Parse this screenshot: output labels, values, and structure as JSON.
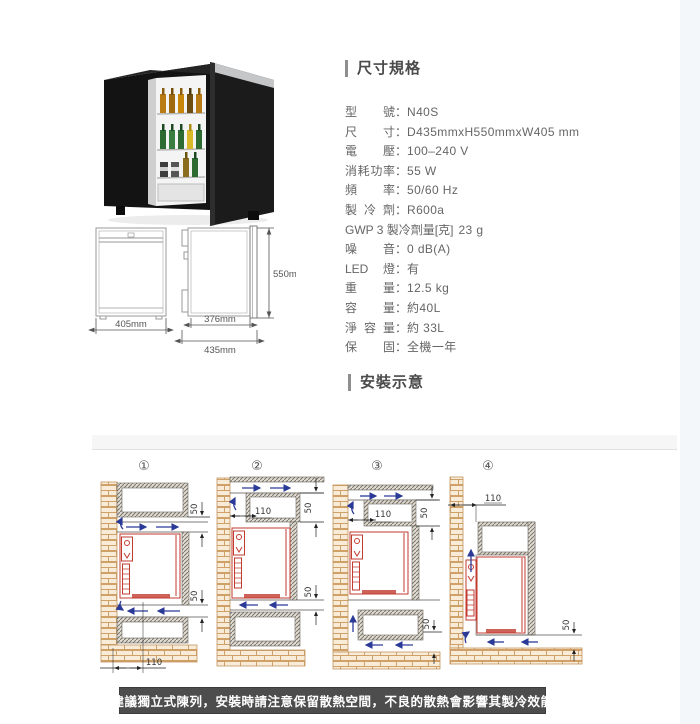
{
  "dimension_drawing": {
    "front_width": "405mm",
    "body_depth": "376mm",
    "total_depth": "435mm",
    "height": "550mm"
  },
  "specs": {
    "heading": "尺寸規格",
    "items": [
      {
        "label": "型號",
        "sep": "：",
        "value": "N40S"
      },
      {
        "label": "尺寸",
        "sep": "：",
        "value": "D435mmxH550mmxW405 mm"
      },
      {
        "label": "電壓",
        "sep": "：",
        "value": "100–240 V"
      },
      {
        "label": "消耗功率",
        "sep": "：",
        "value": "55 W"
      },
      {
        "label": "頻率",
        "sep": "：",
        "value": "50/60 Hz"
      },
      {
        "label": "製冷劑",
        "sep": "：",
        "value": "R600a"
      },
      {
        "label": "GWP 3 製冷劑量[克]",
        "sep": " ",
        "value": "23 g"
      },
      {
        "label": "噪音",
        "sep": "：",
        "value": "0 dB(A)"
      },
      {
        "label": "LED燈",
        "sep": "：",
        "value": "有"
      },
      {
        "label": "重量",
        "sep": "：",
        "value": "12.5 kg"
      },
      {
        "label": "容量",
        "sep": "：",
        "value": "約40L"
      },
      {
        "label": "淨容量",
        "sep": "：",
        "value": "約 33L"
      },
      {
        "label": "保固",
        "sep": "：",
        "value": "全機一年"
      }
    ]
  },
  "installation": {
    "heading": "安裝示意",
    "note": "建議獨立式陳列，安裝時請注意保留散熱空間，不良的散熱會影響其製冷效能",
    "diagrams": [
      {
        "number": "①",
        "dim_top": "50",
        "dim_bottom": "50",
        "dim_width": "110"
      },
      {
        "number": "②",
        "dim_vent": "110",
        "dim_top": "50",
        "dim_bottom": "50"
      },
      {
        "number": "③",
        "dim_vent": "110",
        "dim_top": "50",
        "dim_bottom": "50"
      },
      {
        "number": "④",
        "dim_gap": "110",
        "dim_bottom": "50"
      }
    ]
  },
  "colors": {
    "fridge_red": "#c23b2f",
    "airflow_blue": "#2c3a97",
    "brick_line": "#cfa168",
    "note_bg": "#4d4d4d"
  }
}
